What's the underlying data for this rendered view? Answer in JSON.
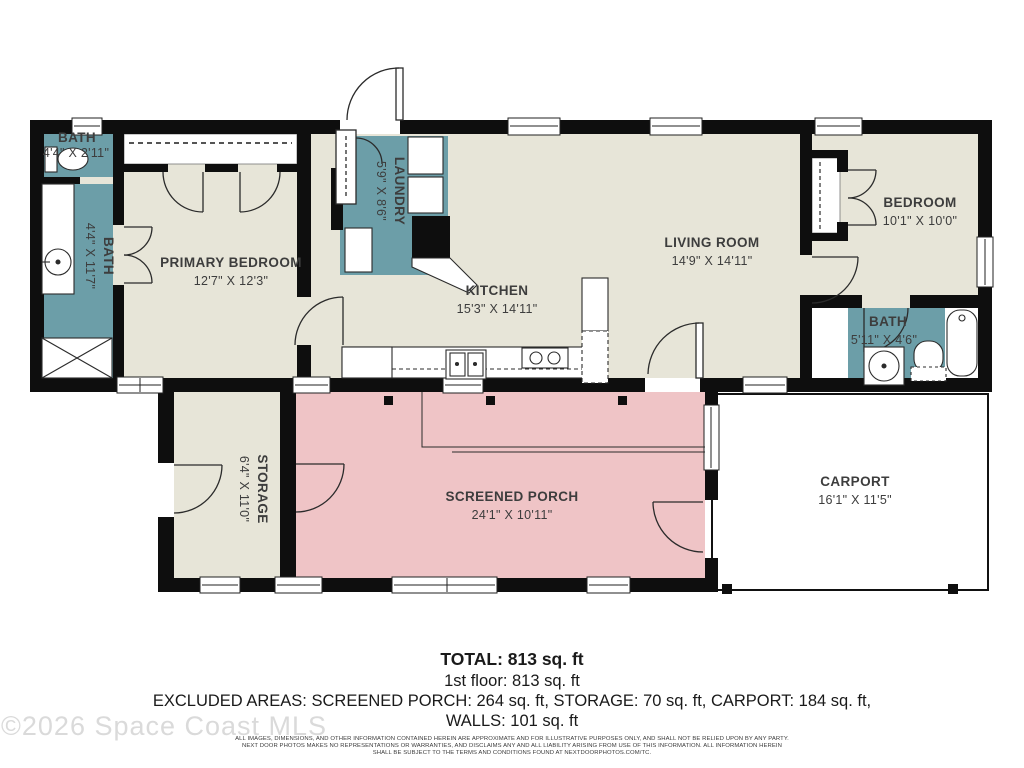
{
  "plan": {
    "colors": {
      "wet_room_teal": "#6C9EA8",
      "floor_beige": "#E7E5D8",
      "porch_pink": "#EFC4C6",
      "wall_black": "#0E0E0E",
      "label_gray": "#3D3D3D"
    },
    "rooms": {
      "bath1": {
        "name": "BATH",
        "dims": "4'4\" X 2'11\""
      },
      "bath2": {
        "name": "BATH",
        "dims": "4'4\" X 11'7\""
      },
      "primary_bedroom": {
        "name": "PRIMARY BEDROOM",
        "dims": "12'7\" X 12'3\""
      },
      "laundry": {
        "name": "LAUNDRY",
        "dims": "5'9\" X 8'6\""
      },
      "kitchen": {
        "name": "KITCHEN",
        "dims": "15'3\" X 14'11\""
      },
      "living_room": {
        "name": "LIVING ROOM",
        "dims": "14'9\" X 14'11\""
      },
      "bedroom": {
        "name": "BEDROOM",
        "dims": "10'1\" X 10'0\""
      },
      "bath3": {
        "name": "BATH",
        "dims": "5'11\" X 4'6\""
      },
      "storage": {
        "name": "STORAGE",
        "dims": "6'4\" X 11'0\""
      },
      "screened_porch": {
        "name": "SCREENED PORCH",
        "dims": "24'1\" X 10'11\""
      },
      "carport": {
        "name": "CARPORT",
        "dims": "16'1\" X 11'5\""
      }
    }
  },
  "footer": {
    "total": "TOTAL: 813 sq. ft",
    "floor1": "1st floor: 813 sq. ft",
    "excluded": "EXCLUDED AREAS: SCREENED PORCH: 264 sq. ft, STORAGE: 70 sq. ft, CARPORT: 184 sq. ft,",
    "walls": "WALLS: 101 sq. ft",
    "disclaimer1": "ALL IMAGES, DIMENSIONS, AND OTHER INFORMATION CONTAINED HEREIN ARE APPROXIMATE AND FOR ILLUSTRATIVE PURPOSES ONLY, AND SHALL NOT BE RELIED UPON BY ANY PARTY.",
    "disclaimer2": "NEXT DOOR PHOTOS MAKES NO REPRESENTATIONS OR WARRANTIES, AND DISCLAIMS ANY AND ALL LIABILITY ARISING FROM USE OF THIS INFORMATION. ALL INFORMATION HEREIN",
    "disclaimer3": "SHALL BE SUBJECT TO THE TERMS AND CONDITIONS FOUND AT NEXTDOORPHOTOS.COM/TC.",
    "watermark": "©2026 Space Coast MLS"
  }
}
